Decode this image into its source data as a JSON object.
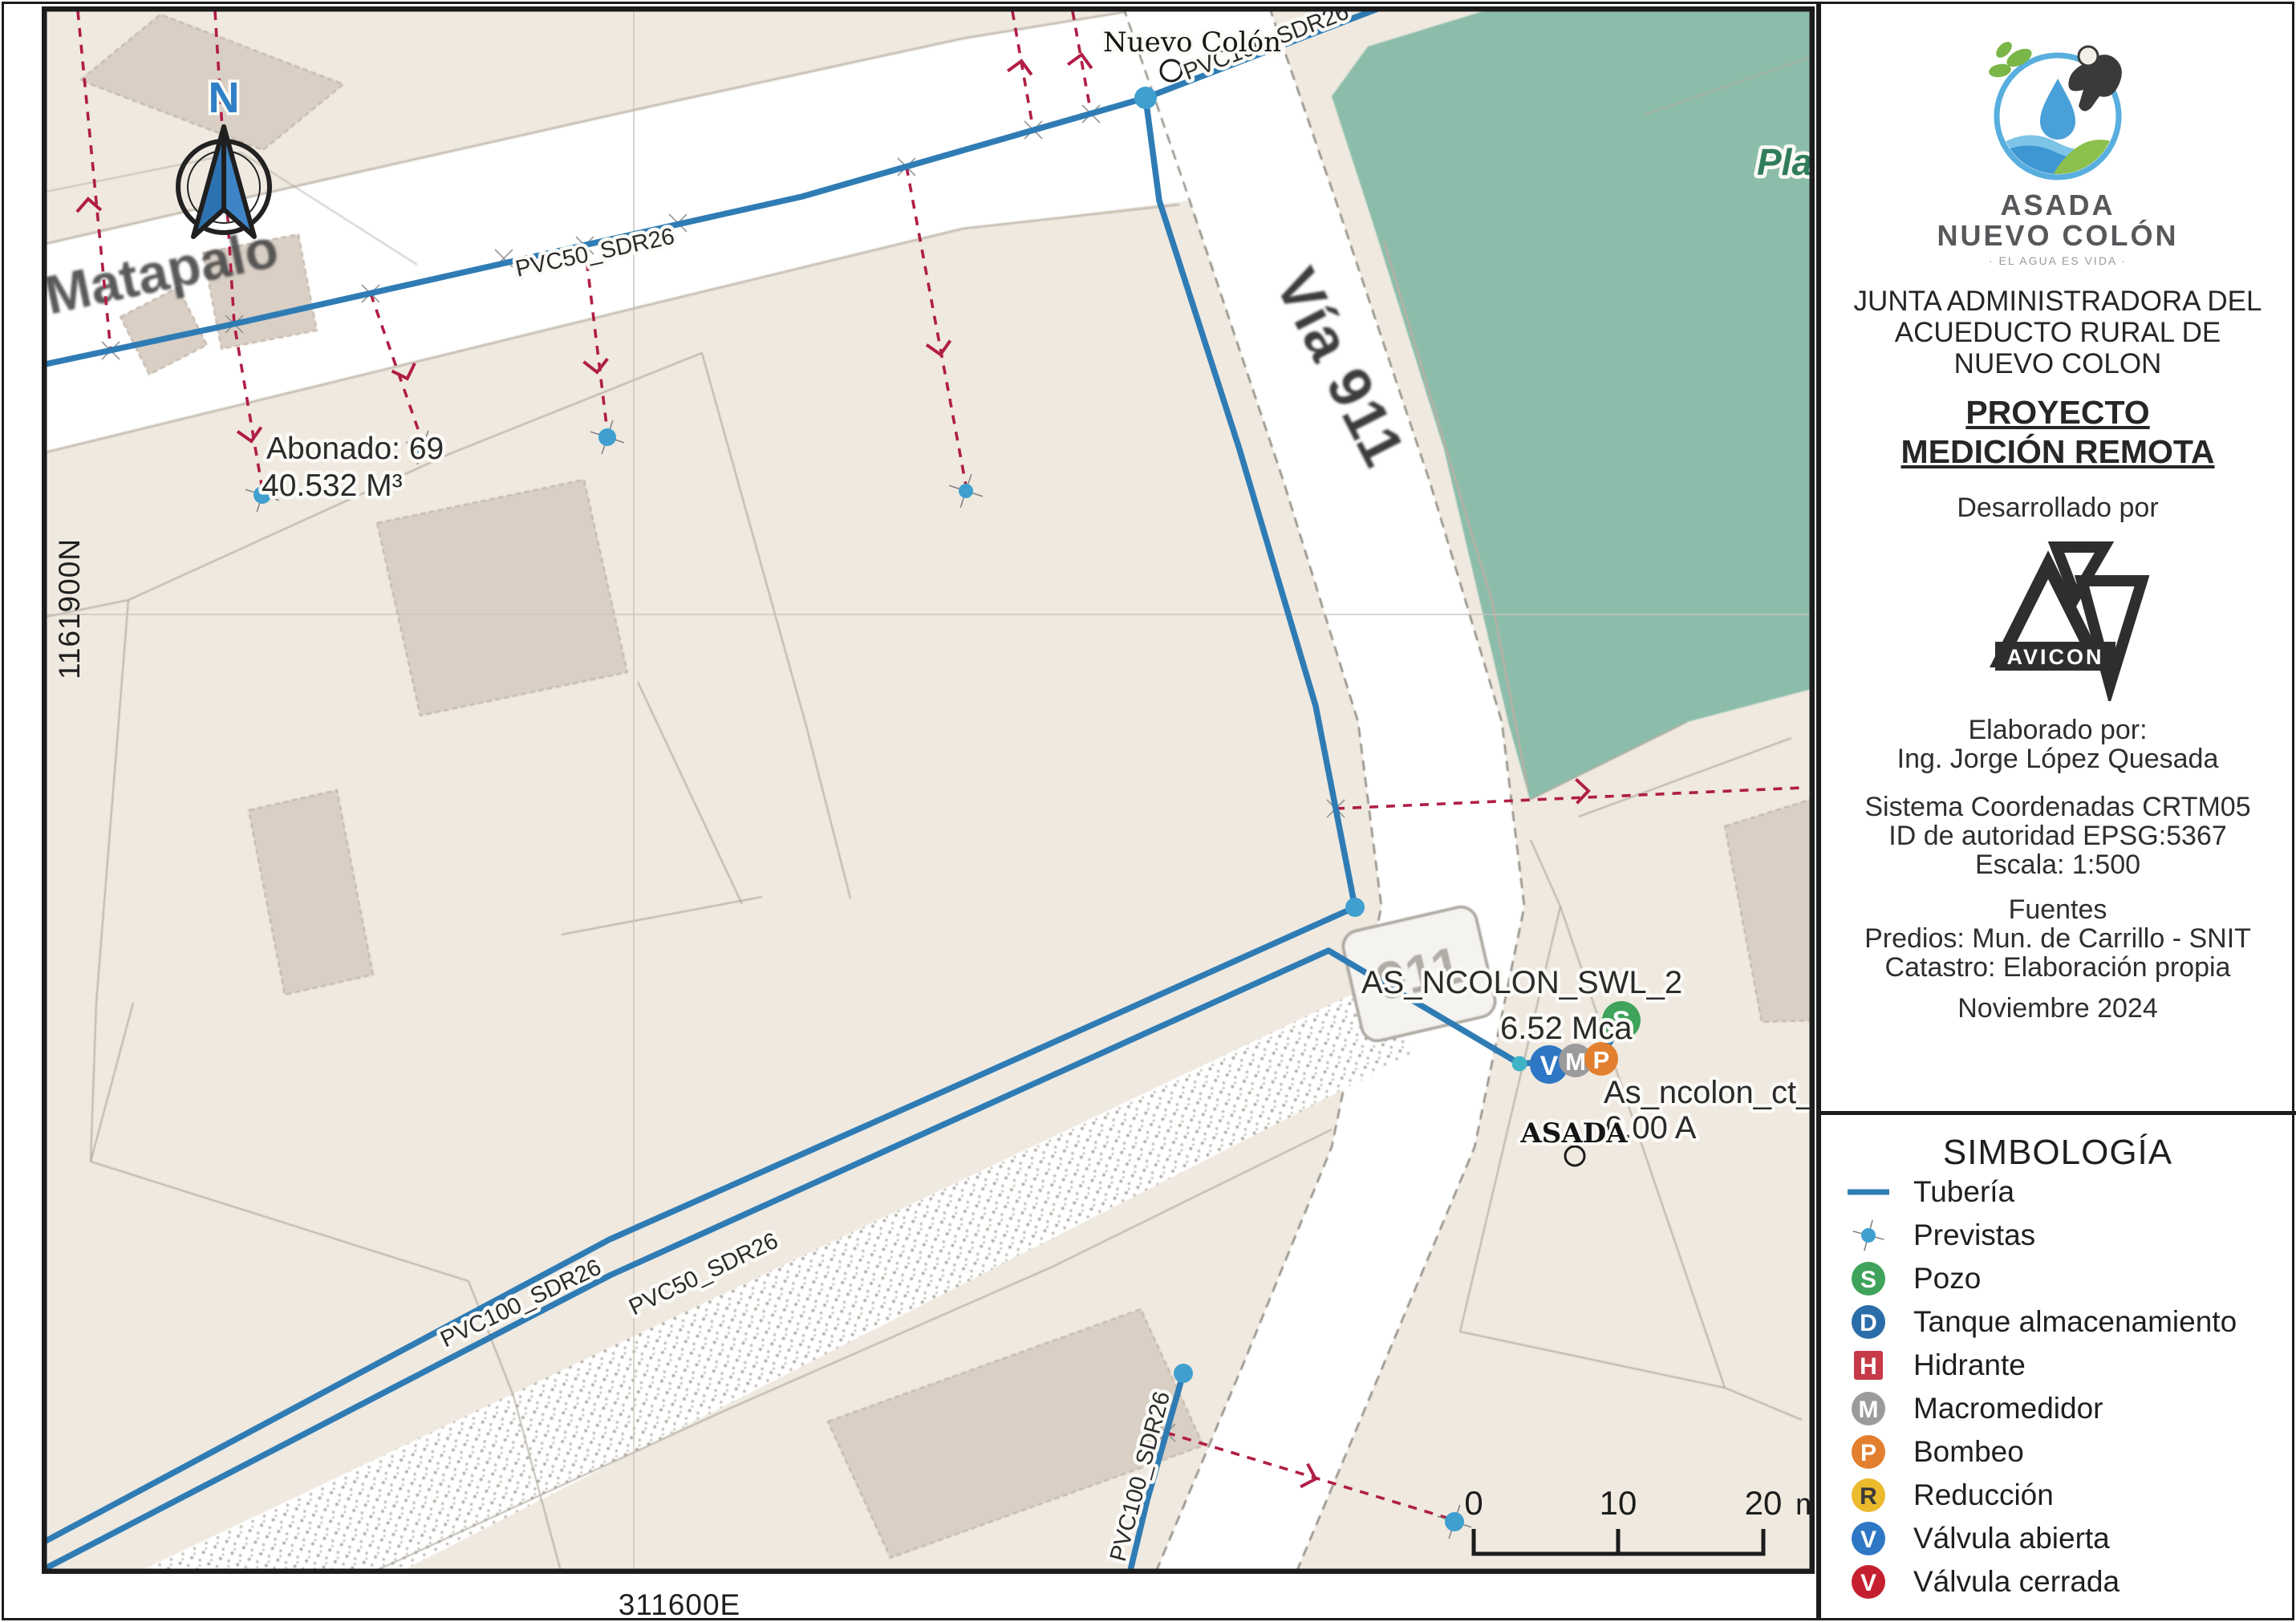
{
  "colors": {
    "pipe": "#2F7CB5",
    "prevista": "#3FA0CF",
    "prevista_teal": "#3FB4C6",
    "service_line": "#B01E45",
    "green_area": "#8CBDAB",
    "road": "#FFFFFF",
    "parcel_bg": "#EFE9E0",
    "building": "#D9CFC5",
    "pozo": "#3FA35B",
    "tanque": "#2B6DA8",
    "hidrante": "#C63947",
    "macromedidor": "#9B9B9B",
    "bombeo": "#E2802F",
    "reduccion": "#EBBA2D",
    "valvula_abierta": "#2D77C4",
    "valvula_cerrada": "#C5202F"
  },
  "map": {
    "grid": {
      "north_label": "1161900N",
      "east_label": "311600E"
    },
    "north_symbol": "N",
    "labels": {
      "town": "Nuevo Colón",
      "town2": "ASADA",
      "road_matapalo": "Matapalo",
      "road_via911": "Vía 911",
      "route_shield": "911",
      "park_partial": "Pla",
      "pipe_pvc100": "PVC100_SDR26",
      "pipe_pvc50": "PVC50_SDR26",
      "abonado_line1": "Abonado: 69",
      "abonado_line2": "40.532 M³",
      "node_swl": "AS_NCOLON_SWL_2",
      "node_swl_value": "6.52 Mca",
      "node_ct": "As_ncolon_ct_1",
      "node_ct_value": "0.00 A"
    },
    "devices": {
      "pozo": "S",
      "valvula": "V",
      "macromedidor": "M",
      "bombeo": "P"
    },
    "scalebar": {
      "ticks": [
        "0",
        "10",
        "20"
      ],
      "unit": "m"
    }
  },
  "panel": {
    "logo": {
      "org_line1": "ASADA",
      "org_line2": "NUEVO COLÓN",
      "tagline": "· EL AGUA ES VIDA ·"
    },
    "title_lines": [
      "JUNTA ADMINISTRADORA DEL",
      "ACUEDUCTO RURAL DE",
      "NUEVO COLON"
    ],
    "project_line1": "PROYECTO ",
    "project_line2": "MEDICIÓN REMOTA",
    "developed_by": "Desarrollado por",
    "avicon": "AVICON",
    "elaborated_lines": [
      "Elaborado por:",
      "Ing. Jorge López Quesada"
    ],
    "crs_lines": [
      "Sistema Coordenadas CRTM05",
      "ID de autoridad EPSG:5367",
      "Escala: 1:500"
    ],
    "sources_lines": [
      "Fuentes",
      "Predios: Mun. de Carrillo - SNIT",
      "Catastro: Elaboración propia"
    ],
    "date": "Noviembre 2024",
    "legend": {
      "title": "SIMBOLOGÍA",
      "items": [
        {
          "type": "line",
          "label": "Tubería",
          "color": "#2F7CB5",
          "icon": "pipe-line-icon"
        },
        {
          "type": "prevista",
          "label": "Previstas",
          "color": "#3FA0CF",
          "icon": "prevista-dot-icon"
        },
        {
          "type": "circle",
          "letter": "S",
          "label": "Pozo",
          "color": "#3FA35B",
          "letter_color": "#ffffff",
          "icon": "well-icon"
        },
        {
          "type": "circle",
          "letter": "D",
          "label": "Tanque almacenamiento",
          "color": "#2B6DA8",
          "letter_color": "#ffffff",
          "icon": "storage-tank-icon"
        },
        {
          "type": "square",
          "letter": "H",
          "label": "Hidrante",
          "color": "#C63947",
          "letter_color": "#ffffff",
          "icon": "hydrant-icon"
        },
        {
          "type": "circle",
          "letter": "M",
          "label": "Macromedidor",
          "color": "#9B9B9B",
          "letter_color": "#ffffff",
          "icon": "macro-meter-icon"
        },
        {
          "type": "circle",
          "letter": "P",
          "label": "Bombeo",
          "color": "#E2802F",
          "letter_color": "#ffffff",
          "icon": "pump-icon"
        },
        {
          "type": "circle",
          "letter": "R",
          "label": "Reducción",
          "color": "#EBBA2D",
          "letter_color": "#3a3a3a",
          "icon": "reducer-icon"
        },
        {
          "type": "circle",
          "letter": "V",
          "label": "Válvula abierta",
          "color": "#2D77C4",
          "letter_color": "#ffffff",
          "icon": "open-valve-icon"
        },
        {
          "type": "circle",
          "letter": "V",
          "label": "Válvula cerrada",
          "color": "#C5202F",
          "letter_color": "#ffffff",
          "icon": "closed-valve-icon"
        }
      ]
    }
  }
}
